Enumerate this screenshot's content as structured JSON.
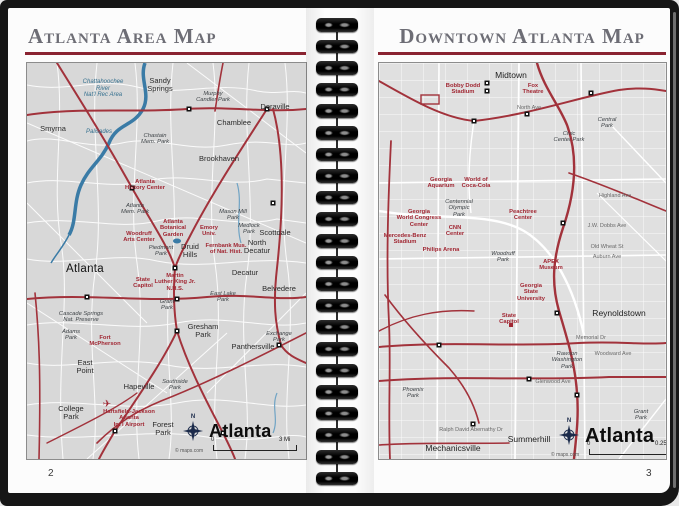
{
  "colors": {
    "title_gray": "#6d6d75",
    "rule_red": "#8a2431",
    "highway_red": "#a2323b",
    "river_blue": "#3a7ba6",
    "map_bg_left": "#d8d8d8",
    "map_bg_right": "#e0e0e0"
  },
  "left_page": {
    "title": "Atlanta Area Map",
    "page_number": "2",
    "map_logo": {
      "compass_label": "N",
      "brand": "Atlanta",
      "scale_start": "0",
      "scale_end": "3 Mi",
      "credit": "© maps.com"
    },
    "labels": [
      {
        "text": "Sandy\nSprings",
        "x": 133,
        "y": 14,
        "cls": "town"
      },
      {
        "text": "Chattahoochee\nRiver\nNat'l Rec Area",
        "x": 76,
        "y": 16,
        "cls": "water"
      },
      {
        "text": "Murphy\nCandler Park",
        "x": 186,
        "y": 28,
        "cls": "park"
      },
      {
        "text": "Doraville",
        "x": 248,
        "y": 40,
        "cls": "town"
      },
      {
        "text": "Chamblee",
        "x": 207,
        "y": 56,
        "cls": "town"
      },
      {
        "text": "Smyrna",
        "x": 26,
        "y": 62,
        "cls": "town"
      },
      {
        "text": "Palisades",
        "x": 72,
        "y": 66,
        "cls": "water"
      },
      {
        "text": "Chastain\nMem. Park",
        "x": 128,
        "y": 70,
        "cls": "park"
      },
      {
        "text": "Brookhaven",
        "x": 192,
        "y": 92,
        "cls": "town"
      },
      {
        "text": "Atlanta\nHistory Center",
        "x": 118,
        "y": 116,
        "cls": "poi"
      },
      {
        "text": "Atlanta\nMem. Park",
        "x": 108,
        "y": 140,
        "cls": "park"
      },
      {
        "text": "Mason Mill\nPark",
        "x": 206,
        "y": 146,
        "cls": "park"
      },
      {
        "text": "Medlock\nPark",
        "x": 222,
        "y": 160,
        "cls": "park"
      },
      {
        "text": "Scottdale",
        "x": 248,
        "y": 166,
        "cls": "town"
      },
      {
        "text": "Atlanta\nBotanical\nGarden",
        "x": 146,
        "y": 156,
        "cls": "poi"
      },
      {
        "text": "Woodruff\nArts Center",
        "x": 112,
        "y": 168,
        "cls": "poi"
      },
      {
        "text": "Emory\nUniv.",
        "x": 182,
        "y": 162,
        "cls": "poi"
      },
      {
        "text": "Piedmont\nPark",
        "x": 134,
        "y": 182,
        "cls": "park"
      },
      {
        "text": "Druid\nHills",
        "x": 163,
        "y": 180,
        "cls": "town"
      },
      {
        "text": "North\nDecatur",
        "x": 230,
        "y": 176,
        "cls": "town"
      },
      {
        "text": "Fernbank Mus.\nof Nat. Hist.",
        "x": 199,
        "y": 180,
        "cls": "poi"
      },
      {
        "text": "Atlanta",
        "x": 58,
        "y": 200,
        "cls": "city-lg"
      },
      {
        "text": "Decatur",
        "x": 218,
        "y": 206,
        "cls": "town"
      },
      {
        "text": "State\nCapitol",
        "x": 116,
        "y": 214,
        "cls": "poi"
      },
      {
        "text": "Martin\nLuther King Jr.\nN.H.S.",
        "x": 148,
        "y": 210,
        "cls": "poi"
      },
      {
        "text": "Belvedere",
        "x": 252,
        "y": 222,
        "cls": "town"
      },
      {
        "text": "East Lake\nPark",
        "x": 196,
        "y": 228,
        "cls": "park"
      },
      {
        "text": "Grant\nPark",
        "x": 140,
        "y": 236,
        "cls": "park"
      },
      {
        "text": "Cascade Springs\nNat. Preserve",
        "x": 54,
        "y": 248,
        "cls": "park"
      },
      {
        "text": "Gresham\nPark",
        "x": 176,
        "y": 260,
        "cls": "town"
      },
      {
        "text": "Adams\nPark",
        "x": 44,
        "y": 266,
        "cls": "park"
      },
      {
        "text": "Exchange\nPark",
        "x": 252,
        "y": 268,
        "cls": "park"
      },
      {
        "text": "Fort\nMcPherson",
        "x": 78,
        "y": 272,
        "cls": "poi"
      },
      {
        "text": "Panthersville",
        "x": 226,
        "y": 280,
        "cls": "town"
      },
      {
        "text": "East\nPoint",
        "x": 58,
        "y": 296,
        "cls": "town"
      },
      {
        "text": "Southside\nPark",
        "x": 148,
        "y": 316,
        "cls": "park"
      },
      {
        "text": "Hapeville",
        "x": 112,
        "y": 320,
        "cls": "town"
      },
      {
        "text": "✈",
        "x": 80,
        "y": 336,
        "cls": "poi-plane"
      },
      {
        "text": "Hartsfield-Jackson\nAtlanta\nInt'l Airport",
        "x": 102,
        "y": 346,
        "cls": "poi"
      },
      {
        "text": "College\nPark",
        "x": 44,
        "y": 342,
        "cls": "town"
      },
      {
        "text": "Forest\nPark",
        "x": 136,
        "y": 358,
        "cls": "town"
      }
    ]
  },
  "right_page": {
    "title": "Downtown Atlanta Map",
    "page_number": "3",
    "map_logo": {
      "compass_label": "N",
      "brand": "Atlanta",
      "scale_start": "0",
      "scale_end": "0.25 Mi",
      "credit": "© maps.com"
    },
    "labels": [
      {
        "text": "Midtown",
        "x": 132,
        "y": 8,
        "cls": "city"
      },
      {
        "text": "Bobby Dodd\nStadium",
        "x": 84,
        "y": 20,
        "cls": "poi"
      },
      {
        "text": "Fox\nTheatre",
        "x": 154,
        "y": 20,
        "cls": "poi"
      },
      {
        "text": "North Ave",
        "x": 150,
        "y": 42,
        "cls": "street"
      },
      {
        "text": "Central\nPark",
        "x": 228,
        "y": 54,
        "cls": "park2"
      },
      {
        "text": "Civic\nCenter Park",
        "x": 190,
        "y": 68,
        "cls": "park2"
      },
      {
        "text": "Georgia\nAquarium",
        "x": 62,
        "y": 114,
        "cls": "poi"
      },
      {
        "text": "World of\nCoca-Cola",
        "x": 97,
        "y": 114,
        "cls": "poi"
      },
      {
        "text": "Highland Ave",
        "x": 236,
        "y": 130,
        "cls": "street"
      },
      {
        "text": "Centennial\nOlympic\nPark",
        "x": 80,
        "y": 136,
        "cls": "park2"
      },
      {
        "text": "Georgia\nWorld Congress\nCenter",
        "x": 40,
        "y": 146,
        "cls": "poi"
      },
      {
        "text": "Peachtree\nCenter",
        "x": 144,
        "y": 146,
        "cls": "poi"
      },
      {
        "text": "CNN\nCenter",
        "x": 76,
        "y": 162,
        "cls": "poi"
      },
      {
        "text": "Mercedes-Benz\nStadium",
        "x": 26,
        "y": 170,
        "cls": "poi"
      },
      {
        "text": "J.W. Dobbs Ave",
        "x": 228,
        "y": 160,
        "cls": "street"
      },
      {
        "text": "Philips Arena",
        "x": 62,
        "y": 184,
        "cls": "poi"
      },
      {
        "text": "Old Wheat St",
        "x": 228,
        "y": 181,
        "cls": "street"
      },
      {
        "text": "Woodruff\nPark",
        "x": 124,
        "y": 188,
        "cls": "park2"
      },
      {
        "text": "Auburn Ave",
        "x": 228,
        "y": 191,
        "cls": "street"
      },
      {
        "text": "APEX\nMuseum",
        "x": 172,
        "y": 196,
        "cls": "poi"
      },
      {
        "text": "Georgia\nState\nUniversity",
        "x": 152,
        "y": 220,
        "cls": "poi"
      },
      {
        "text": "Reynoldstown",
        "x": 240,
        "y": 246,
        "cls": "city"
      },
      {
        "text": "State\nCapitol",
        "x": 130,
        "y": 250,
        "cls": "poi"
      },
      {
        "text": "Memorial Dr",
        "x": 212,
        "y": 272,
        "cls": "street"
      },
      {
        "text": "Woodward Ave",
        "x": 234,
        "y": 288,
        "cls": "street"
      },
      {
        "text": "Rawson\nWashington\nPark",
        "x": 188,
        "y": 288,
        "cls": "park2"
      },
      {
        "text": "Glenwood Ave",
        "x": 174,
        "y": 316,
        "cls": "street"
      },
      {
        "text": "Phoenix\nPark",
        "x": 34,
        "y": 324,
        "cls": "park2"
      },
      {
        "text": "Grant\nPark",
        "x": 262,
        "y": 346,
        "cls": "park2"
      },
      {
        "text": "Ralph David Abernathy Dr",
        "x": 92,
        "y": 364,
        "cls": "street"
      },
      {
        "text": "Summerhill",
        "x": 150,
        "y": 372,
        "cls": "city"
      },
      {
        "text": "Mechanicsville",
        "x": 74,
        "y": 381,
        "cls": "city"
      }
    ]
  }
}
